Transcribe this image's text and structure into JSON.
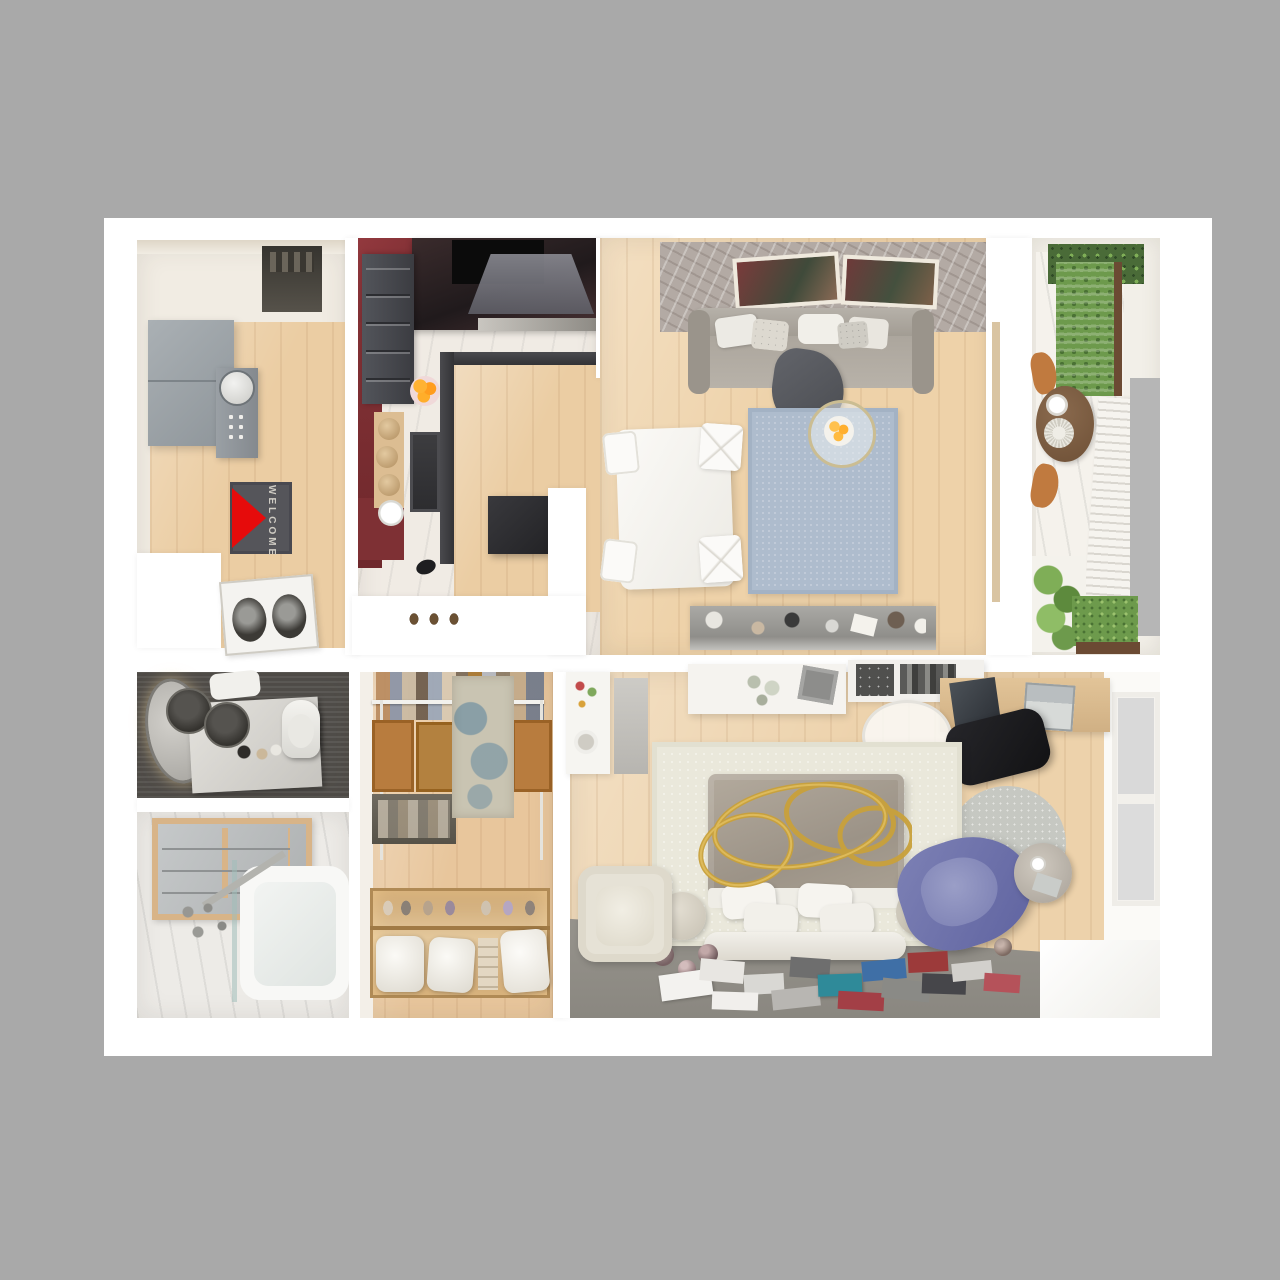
{
  "scene": {
    "type": "3d-apartment-floor-plan-render",
    "view": "top-down",
    "background_color": "#a9a9a9",
    "sheet_color": "#ffffff",
    "sections": 2
  },
  "rooms": {
    "entry_hall": {
      "label": "entry hall",
      "welcome_mat_text": "WELCOME",
      "furniture": [
        "gray wardrobe cabinet",
        "console with round mirror",
        "welcome doormat with red triangle",
        "stacked washer and dryer"
      ]
    },
    "kitchen": {
      "label": "kitchen",
      "furniture": [
        "dark L-shaped cabinets",
        "cooktop with hood",
        "sink",
        "bar stools",
        "fruit bowl",
        "white partition wall"
      ],
      "accent_floor": "#7e3034"
    },
    "living_dining": {
      "label": "living and dining room",
      "furniture": [
        "gray sofa with pillows and throw",
        "blue rug",
        "round glass coffee table with fruit",
        "white dining table with four chairs",
        "tv sideboard with decor",
        "brick feature wall with two pictures"
      ]
    },
    "balcony": {
      "label": "balcony",
      "furniture": [
        "vertical garden planters",
        "round wooden table with plates",
        "two wooden chairs",
        "white slat railing",
        "potted plants"
      ]
    },
    "bathroom": {
      "label": "bathroom",
      "furniture": [
        "oval backlit mirror",
        "double dark basins on vanity",
        "toilet",
        "wood framed cabinet",
        "bathtub with glass screen"
      ]
    },
    "wardrobe": {
      "label": "walk-in wardrobe",
      "furniture": [
        "hanging clothes rail",
        "wooden crate shelves",
        "vintage blue rug",
        "lit shoe and pillow shelving"
      ]
    },
    "bedroom": {
      "label": "bedroom",
      "furniture": [
        "bed with gray duvet and white pillows",
        "gold ring chandelier",
        "cream rug",
        "cream armchair",
        "blue lounge chair",
        "round gray rug",
        "marble side table",
        "desk with laptop",
        "black office chair",
        "white dresser",
        "scattered books and magazines",
        "window"
      ]
    }
  },
  "palette": {
    "wood_floor": "#ebcda3",
    "marble": "#f0ebe4",
    "burgundy": "#7e3034",
    "dark_cabinet": "#46474c",
    "sofa_gray": "#a9a49c",
    "rug_blue": "#aebccd",
    "brick_wall": "#b3aaa4",
    "bath_dark": "#504d49",
    "crate_wood": "#b87c3e",
    "bedroom_rug": "#eae8db",
    "duvet_gray": "#a89f93",
    "gold": "#c9a13b",
    "blue_chair": "#6d71a8",
    "greens": "#6d9a4c",
    "mat_red": "#e60b0b"
  }
}
